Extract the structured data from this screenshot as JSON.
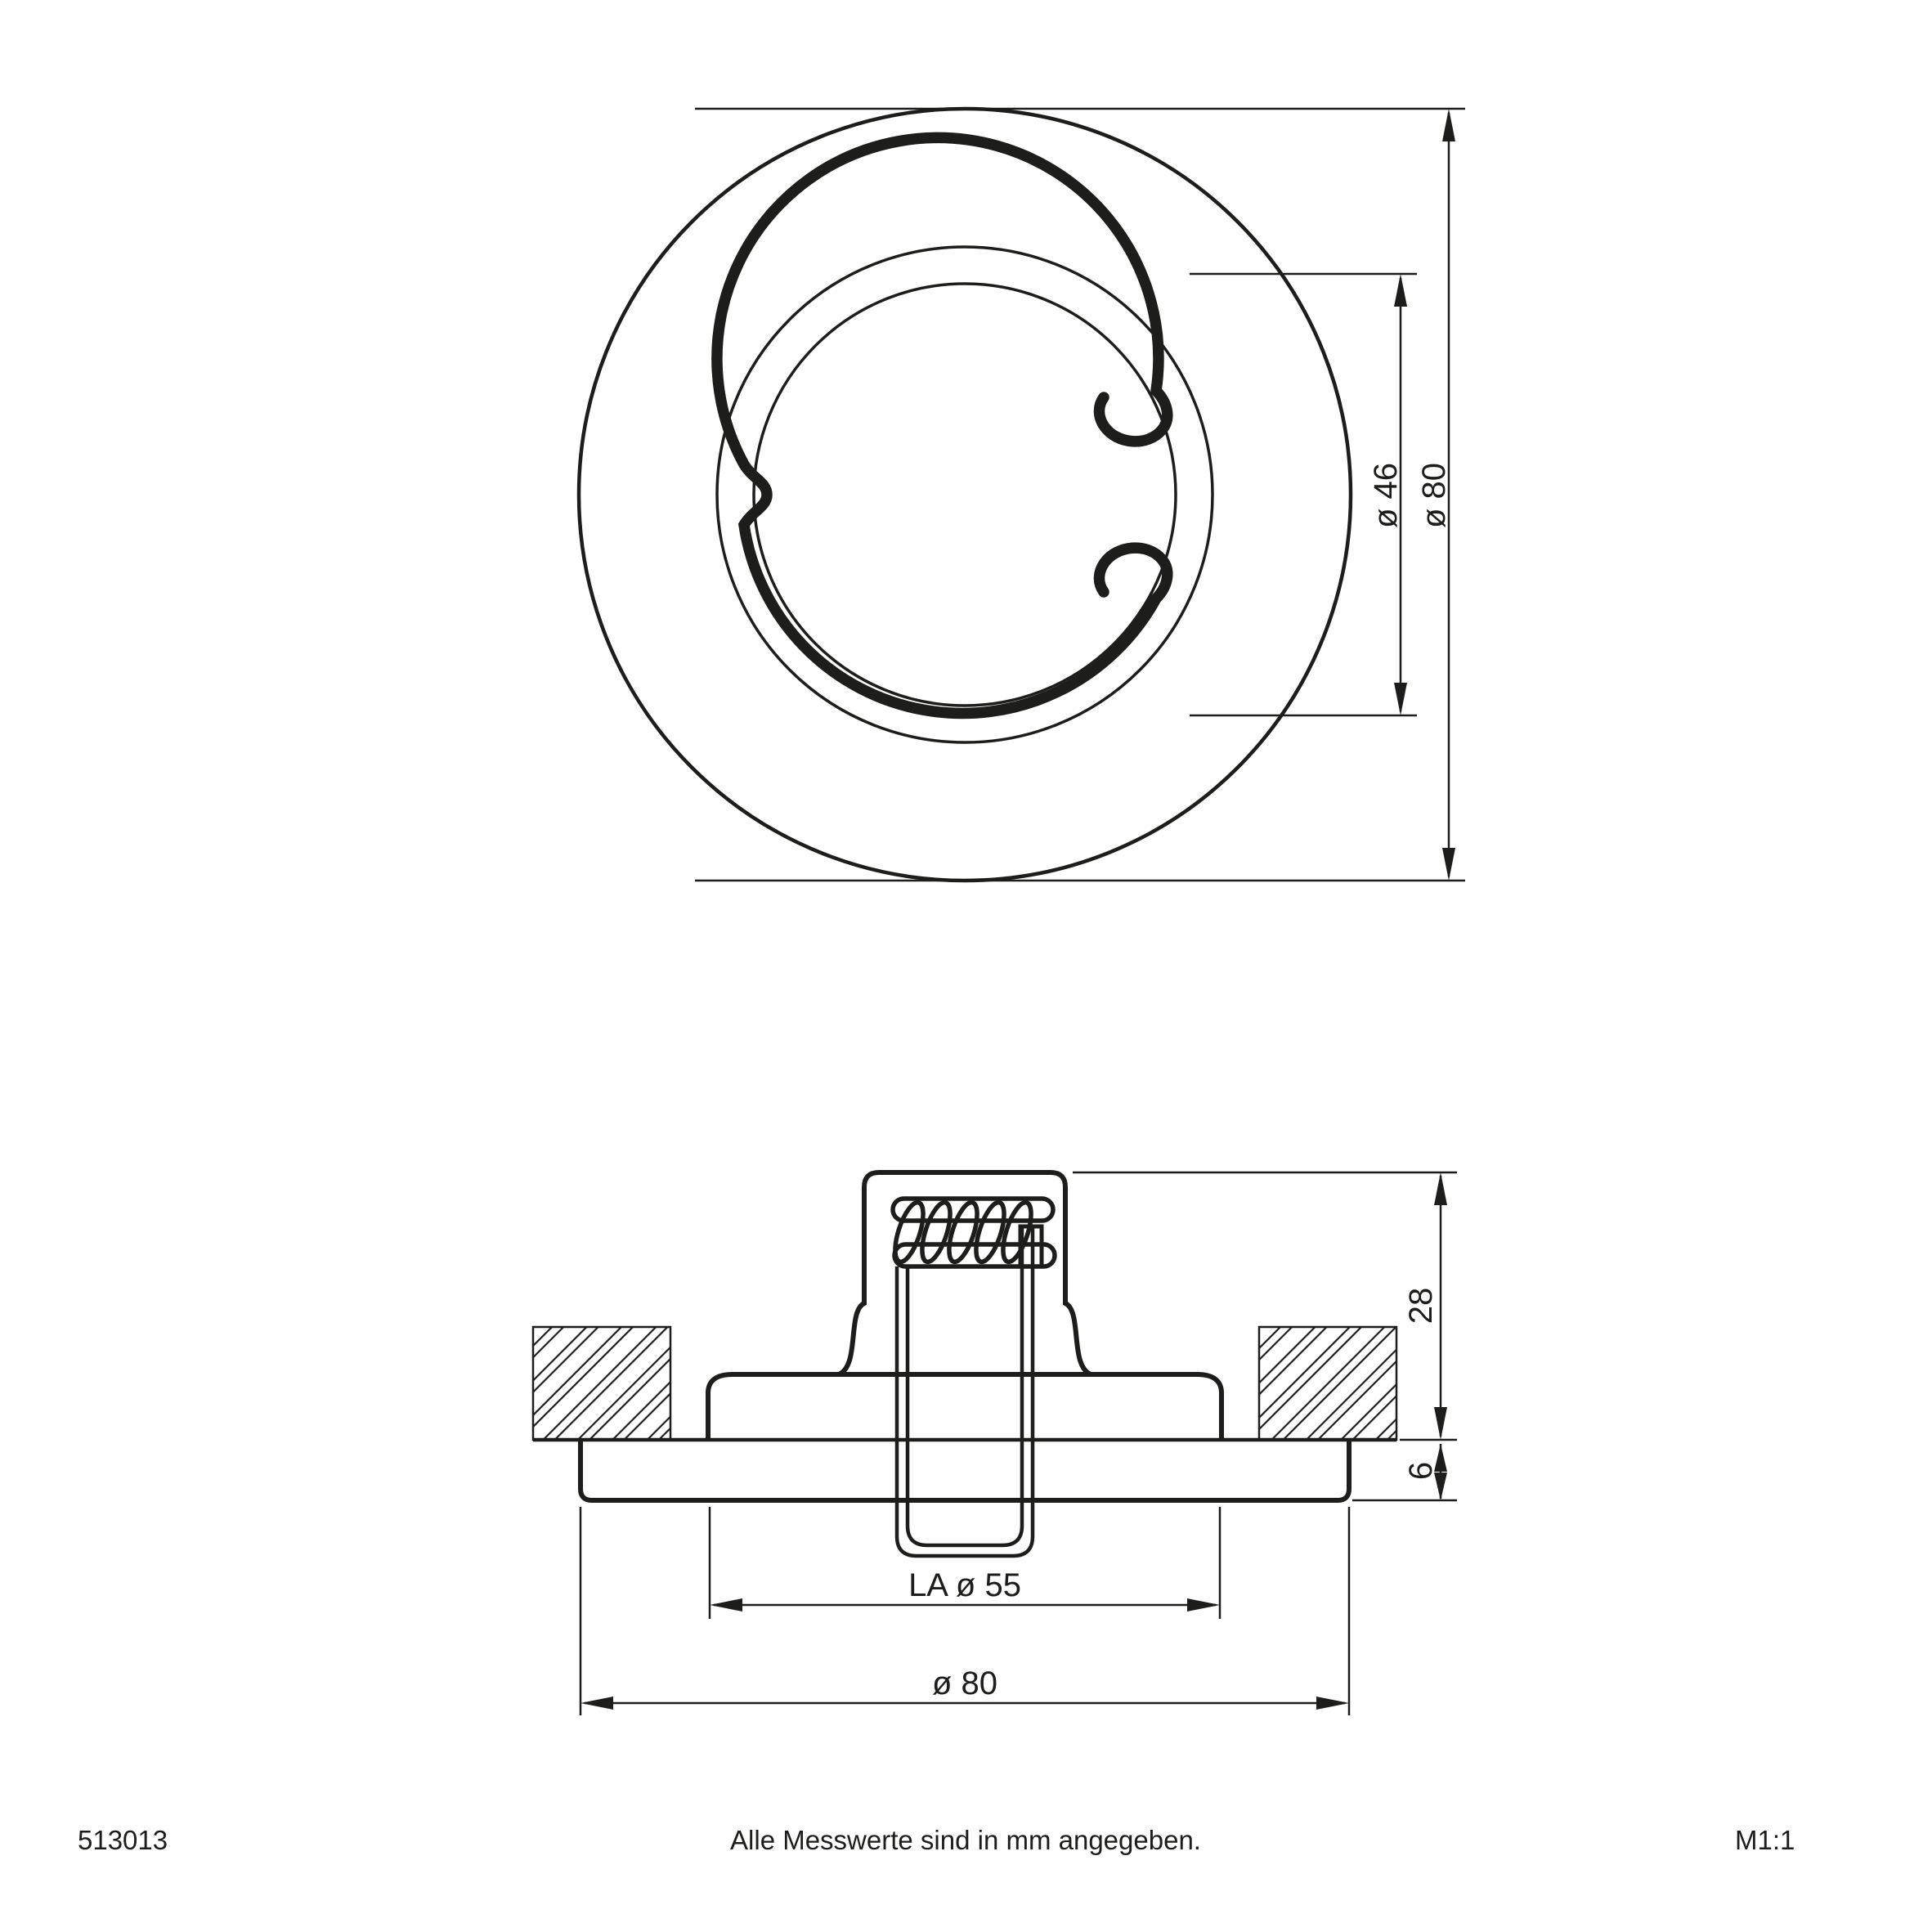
{
  "drawing": {
    "top_view": {
      "dim_spring_ring": "ø 46",
      "dim_outer": "ø 80"
    },
    "section_view": {
      "dim_height_above_ceiling": "28",
      "dim_flange_thickness": "6",
      "dim_cutout": "LA ø 55",
      "dim_outer_diameter": "ø 80"
    },
    "footer": {
      "article_number": "513013",
      "note": "Alle Messwerte sind in mm angegeben.",
      "scale": "M1:1"
    },
    "colors": {
      "line": "#1d1d1b",
      "background": "#ffffff"
    }
  }
}
